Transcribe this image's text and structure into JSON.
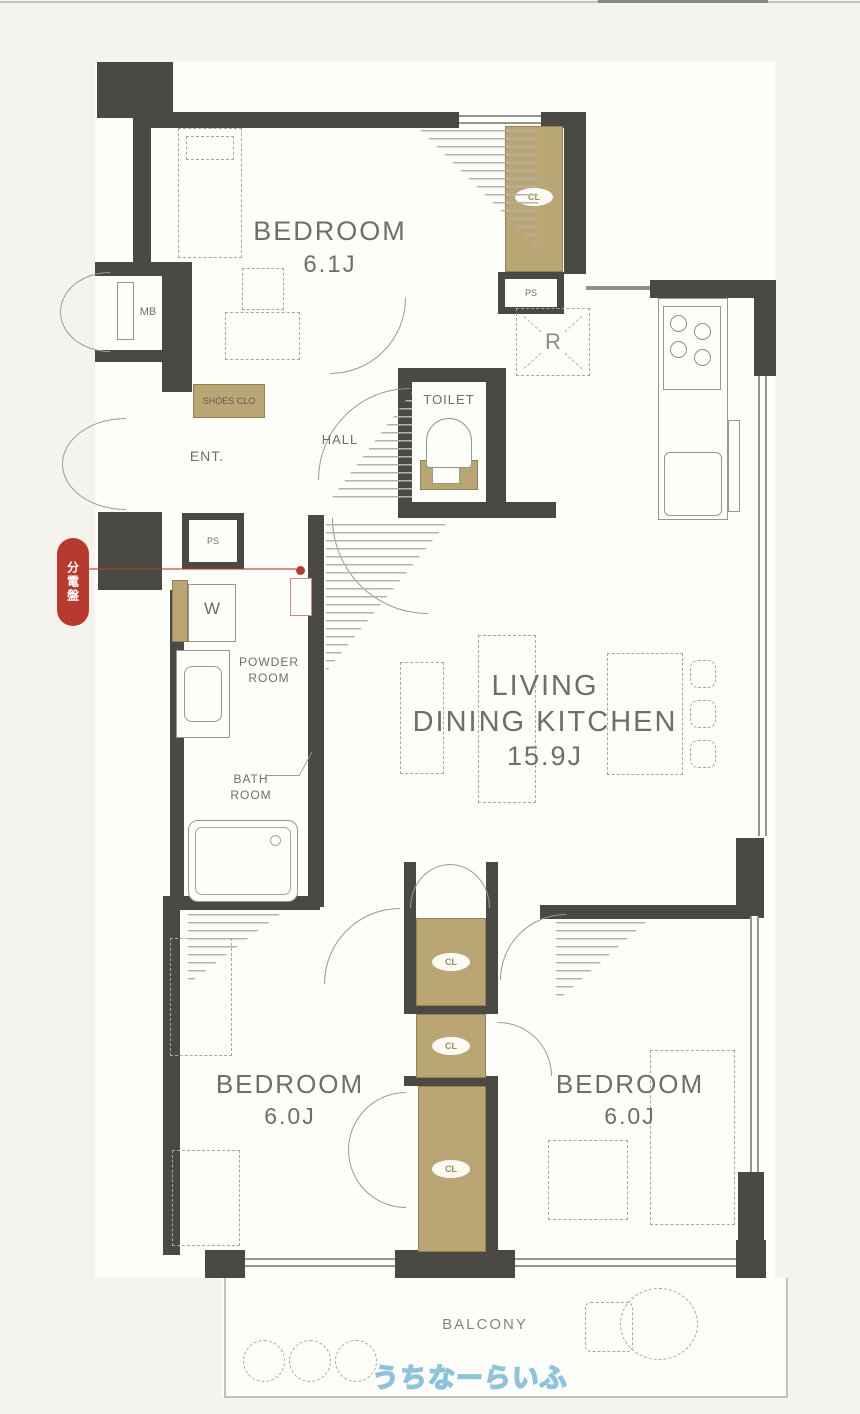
{
  "plan_title": "apartment-floor-plan",
  "colors": {
    "wall": "#4a4944",
    "closet_tan": "#b9a674",
    "background": "#f4f3ee",
    "room_white": "#fdfdfa",
    "label_gray": "#6f6e67",
    "badge_red": "#b63a2f",
    "watermark_blue": "#8fc3dc"
  },
  "rooms": {
    "bedroom1": {
      "name": "BEDROOM",
      "size": "6.1J"
    },
    "ldk": {
      "line1": "LIVING",
      "line2": "DINING KITCHEN",
      "size": "15.9J"
    },
    "bedroom2": {
      "name": "BEDROOM",
      "size": "6.0J"
    },
    "bedroom3": {
      "name": "BEDROOM",
      "size": "6.0J"
    },
    "toilet": "TOILET",
    "hall": "HALL",
    "entrance": "ENT.",
    "shoes_closet": "SHOES CLO",
    "powder_line1": "POWDER",
    "powder_line2": "ROOM",
    "bath_line1": "BATH",
    "bath_line2": "ROOM",
    "balcony": "BALCONY"
  },
  "labels": {
    "meter_box": "MB",
    "pipe_space": "PS",
    "washer": "W",
    "refrigerator": "R",
    "closet": "CL"
  },
  "badge": {
    "text": "分電盤"
  },
  "watermark": {
    "text": "うちなーらいふ"
  }
}
